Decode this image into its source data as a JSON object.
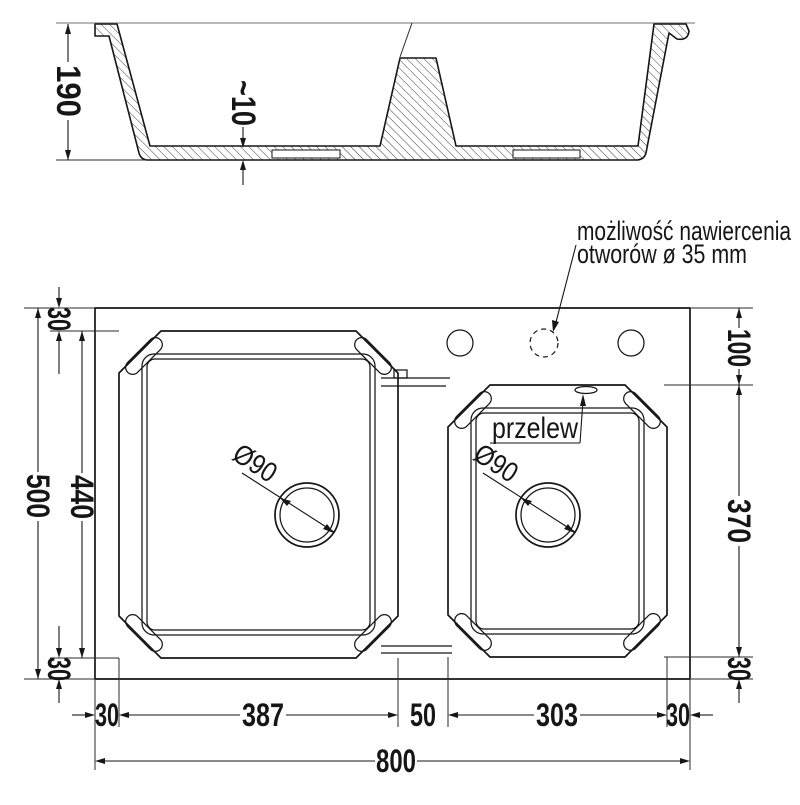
{
  "side_view": {
    "depth_label": "190",
    "floor_label": "~10"
  },
  "plan_view": {
    "overflow_label": "przelew",
    "drain_left_label": "Ø90",
    "drain_right_label": "Ø90",
    "annotation_line1": "możliwość nawiercenia",
    "annotation_line2": "otworów ø 35 mm",
    "dims": {
      "total_height": "500",
      "left_top": "30",
      "left_bowl": "440",
      "left_bottom": "30",
      "right_top": "100",
      "right_bowl": "370",
      "right_bottom": "30",
      "bottom_left_margin": "30",
      "bottom_left_bowl": "387",
      "bottom_divider": "50",
      "bottom_right_bowl": "303",
      "bottom_right_margin": "30",
      "total_width": "800"
    }
  },
  "colors": {
    "line": "#161616",
    "guide": "#8c8c8c"
  }
}
